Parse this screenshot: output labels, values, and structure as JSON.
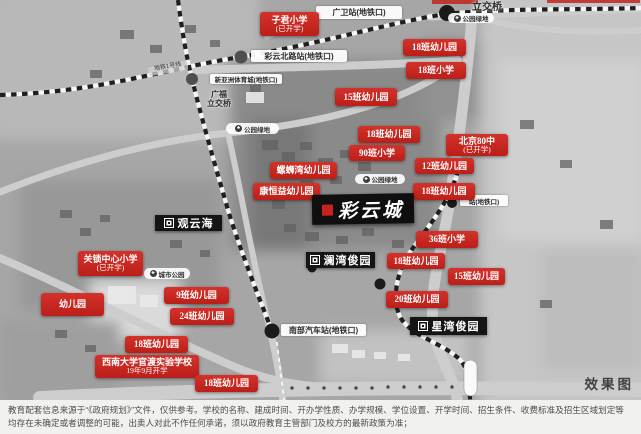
{
  "map": {
    "watermark": "效果图",
    "project_box": {
      "name": "彩云城",
      "x": 312,
      "y": 194,
      "w": 102,
      "h": 30
    },
    "community_boxes": [
      {
        "name": "观云海",
        "x": 155,
        "y": 215,
        "w": 67,
        "h": 16
      },
      {
        "name": "澜湾俊园",
        "x": 306,
        "y": 252,
        "w": 69,
        "h": 16
      },
      {
        "name": "星湾俊园",
        "x": 410,
        "y": 317,
        "w": 77,
        "h": 18
      }
    ],
    "red_labels": [
      {
        "text": "子君小学",
        "text2": "(已开学)",
        "x": 260,
        "y": 12,
        "w": 59,
        "h": 24
      },
      {
        "text": "18班幼儿园",
        "x": 403,
        "y": 39,
        "w": 63,
        "h": 17
      },
      {
        "text": "18班小学",
        "x": 406,
        "y": 62,
        "w": 60,
        "h": 17
      },
      {
        "text": "15班幼儿园",
        "x": 335,
        "y": 88,
        "w": 62,
        "h": 18
      },
      {
        "text": "18班幼儿园",
        "x": 358,
        "y": 126,
        "w": 62,
        "h": 17
      },
      {
        "text": "90班小学",
        "x": 349,
        "y": 145,
        "w": 56,
        "h": 16
      },
      {
        "text": "北京80中",
        "text2": "(已开学)",
        "x": 446,
        "y": 134,
        "w": 62,
        "h": 22
      },
      {
        "text": "12班幼儿园",
        "x": 415,
        "y": 158,
        "w": 59,
        "h": 16
      },
      {
        "text": "18班幼儿园",
        "x": 413,
        "y": 183,
        "w": 62,
        "h": 17
      },
      {
        "text": "螺蛳湾幼儿园",
        "x": 270,
        "y": 162,
        "w": 67,
        "h": 17
      },
      {
        "text": "康恒益幼儿园",
        "x": 253,
        "y": 183,
        "w": 67,
        "h": 17
      },
      {
        "text": "关锁中心小学",
        "text2": "(已开学)",
        "x": 78,
        "y": 251,
        "w": 65,
        "h": 25
      },
      {
        "text": "幼儿园",
        "x": 41,
        "y": 293,
        "w": 63,
        "h": 23
      },
      {
        "text": "9班幼儿园",
        "x": 164,
        "y": 287,
        "w": 65,
        "h": 17
      },
      {
        "text": "24班幼儿园",
        "x": 170,
        "y": 308,
        "w": 64,
        "h": 17
      },
      {
        "text": "18班幼儿园",
        "x": 125,
        "y": 336,
        "w": 63,
        "h": 17
      },
      {
        "text": "西南大学官渡实验学校",
        "text2": "19年9月开学",
        "x": 95,
        "y": 355,
        "w": 104,
        "h": 23
      },
      {
        "text": "18班幼儿园",
        "x": 195,
        "y": 375,
        "w": 63,
        "h": 17
      },
      {
        "text": "36班小学",
        "x": 416,
        "y": 231,
        "w": 62,
        "h": 17
      },
      {
        "text": "18班幼儿园",
        "x": 387,
        "y": 253,
        "w": 58,
        "h": 16
      },
      {
        "text": "15班幼儿园",
        "x": 448,
        "y": 268,
        "w": 57,
        "h": 17
      },
      {
        "text": "20班幼儿园",
        "x": 386,
        "y": 291,
        "w": 62,
        "h": 17
      }
    ],
    "station_labels": [
      {
        "text": "广卫站(地铁口)",
        "x": 316,
        "y": 6,
        "w": 82,
        "h": 13,
        "small": false
      },
      {
        "text": "彩云北路站(地铁口)",
        "x": 251,
        "y": 50,
        "w": 92,
        "h": 12,
        "small": false
      },
      {
        "text": "新亚洲体育城(地铁口)",
        "x": 210,
        "y": 74,
        "w": 68,
        "h": 10,
        "small": true
      },
      {
        "text": "南部汽车站(地铁口)",
        "x": 281,
        "y": 324,
        "w": 81,
        "h": 12,
        "small": false
      },
      {
        "text": "站(地铁口)",
        "x": 460,
        "y": 195,
        "w": 44,
        "h": 11,
        "small": true
      }
    ],
    "place_labels": [
      {
        "text": "公园绿地",
        "x": 226,
        "y": 123,
        "w": 49,
        "h": 11
      },
      {
        "text": "公园绿地",
        "x": 448,
        "y": 13,
        "w": 42,
        "h": 10
      },
      {
        "text": "公园绿地",
        "x": 355,
        "y": 174,
        "w": 46,
        "h": 10
      },
      {
        "text": "城市公园",
        "x": 144,
        "y": 268,
        "w": 42,
        "h": 11
      }
    ],
    "plain_labels": [
      {
        "text": "立交桥",
        "x": 468,
        "y": 2,
        "w": 38,
        "h": 13,
        "size": 10,
        "rot": 0,
        "tag": false
      },
      {
        "text": "广福",
        "text2": "立交桥",
        "x": 202,
        "y": 91,
        "w": 34,
        "h": 22,
        "size": 8,
        "rot": 0,
        "tag": false
      },
      {
        "text": "地铁1号线",
        "x": 148,
        "y": 64,
        "w": 36,
        "h": 9,
        "size": 6,
        "rot": -10,
        "tag": true
      },
      {
        "text": "地铁1号线",
        "x": 262,
        "y": 24,
        "w": 36,
        "h": 9,
        "size": 6,
        "rot": -22,
        "tag": true
      }
    ]
  },
  "disclaimer": {
    "line1": "教育配套信息来源于“《政府规划》”文件，仅供参考。学校的名称、建成时间、开办学性质、办学规模、学位设置、开学时间、招生条件、收费标准及招生区域划定等",
    "line2": "均存在未确定或者调整的可能，出卖人对此不作任何承诺，须以政府教育主管部门及校方的最新政策为准；"
  }
}
